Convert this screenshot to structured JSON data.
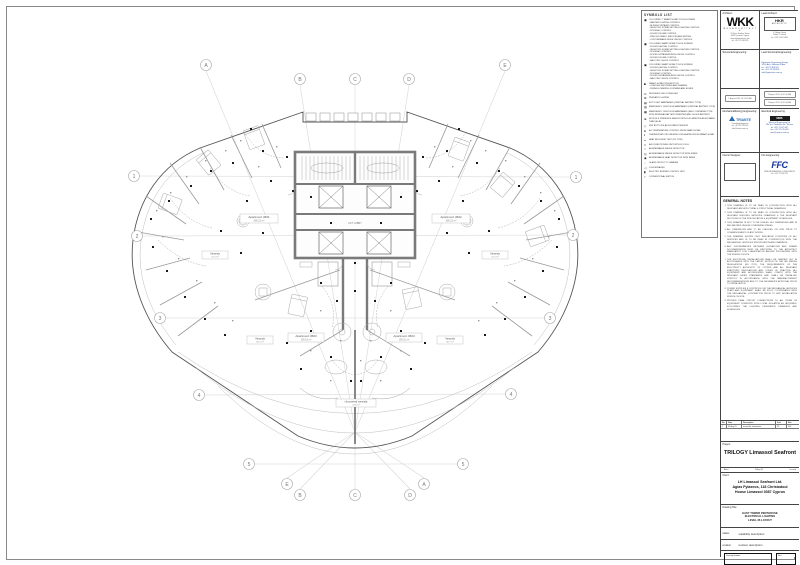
{
  "legend": {
    "title": "SYMBOLS LIST",
    "items": [
      {
        "glyph": "▣",
        "name": "touchscreen-7in-icon",
        "text": "COLOURED 7\" SMART HOME TOUCH SCREEN\n- MASTER LIGHTING CONTROL\n- BLINDS/CURTAINS CONTROL\n- SELECTED SCENE SETTING LIGHTING CONTROL\n- ROOM A/C CONTROL\n- ROOM VOLUME CONTROL\n- RING DOORBELL (INDOOR) AND MUTING\n- CUSTOMISABLE MODE ON/OFF CONTROL"
      },
      {
        "glyph": "▣",
        "name": "touchscreen-icon",
        "text": "COLOURED SMART HOME TOUCH SCREEN\n- ROOM LIGHTING CONTROL\n- SELECTED SCENE SETTING LIGHTING CONTROL\n- ROOM A/C CONTROL\n- ROOM CURTAINS/BLINDS ON/OFF CONTROL\n- ROOM VOLUME CONTROL\n- BALCONY LIGHTS CONTROL"
      },
      {
        "glyph": "▣",
        "name": "touchscreen-icon",
        "text": "COLOURED SMART HOME TOUCH SCREEN\n- ROOM LIGHTING CONTROL\n- SELECTED SCENE SETTING LIGHTING CONTROL\n- ROOM A/C CONTROL\n- ROOM CURTAINS/BLINDS ON/OFF CONTROL\n- BALCONY LIGHTS CONTROL"
      },
      {
        "glyph": "■",
        "name": "push-button-icon",
        "text": "SMART HOME PUSH BUTTON\n- LIGHTING SWITCHING AND DIMMING\n- RISING/LOWERING CURTAINS AND BLINDS"
      },
      {
        "glyph": "⊙",
        "name": "downlight-icon",
        "text": "RECESSED LED DOWNLIGHT"
      },
      {
        "glyph": "⊗",
        "name": "pendant-icon",
        "text": "PENDANT LIGHTING"
      },
      {
        "glyph": "▤",
        "name": "exit-light-icon",
        "text": "EXIT LIGHT MAINTAINED (CENTRAL BATTERY TYPE)"
      },
      {
        "glyph": "▥",
        "name": "emergency-light-icon",
        "text": "EMERGENCY LIGHT NON MAINTAINED (CENTRAL BATTERY TYPE)"
      },
      {
        "glyph": "▦",
        "name": "emergency-light-self-icon",
        "text": "EMERGENCY LIGHT NON MAINTAINED (SELF CONTAINED TYPE WITH INTERNAL BATTERY INVERTER AND 3 HOUR BATTERY)"
      },
      {
        "glyph": "⊕",
        "name": "motion-sensor-icon",
        "text": "MOTION & PRESENCE SENSOR WITH 0-30 MINUTES ADJUSTABLE TIME DELAY"
      },
      {
        "glyph": "◇",
        "name": "knx-button-icon",
        "text": "KNX BUTTON & ADJUSTMENT SENSOR"
      },
      {
        "glyph": "●",
        "name": "ac-control-icon",
        "text": "A/C TEMPERATURE CONTROL FROM SMART HOME"
      },
      {
        "glyph": "◐",
        "name": "thermostat-icon",
        "text": "THERMOSTAT FOR UNDERFLOOR HEATING FROM SMART HOME"
      },
      {
        "glyph": "◒",
        "name": "heat-recovery-icon",
        "text": "HEAT RECOVERY UNIT (VS TYPE)"
      },
      {
        "glyph": "□",
        "name": "fcu-icon",
        "text": "AIR CONDITIONING UNIT WITH FCU FILL"
      },
      {
        "glyph": "○",
        "name": "smoke-detector-icon",
        "text": "ADDRESSABLE SMOKE DETECTOR"
      },
      {
        "glyph": "◎",
        "name": "smoke-detector-siren-icon",
        "text": "ADDRESSABLE SMOKE DETECTOR WITH SIREN"
      },
      {
        "glyph": "◉",
        "name": "heat-detector-siren-icon",
        "text": "ADDRESSABLE HEAT DETECTOR WITH SIREN"
      },
      {
        "glyph": "◌",
        "name": "glass-circuit-icon",
        "text": "GLASS CIRCUIT TO CAMERA"
      },
      {
        "glyph": "◁",
        "name": "loudspeaker-icon",
        "text": "LOUDSPEAKER"
      },
      {
        "glyph": "▮",
        "name": "burner-unit-icon",
        "text": "ELECTRIC BURNER CONTROL UNIT"
      },
      {
        "glyph": "⌐",
        "name": "conventional-switch-icon",
        "text": "CONVENTIONAL SWITCH"
      }
    ]
  },
  "titleblock": {
    "architect": {
      "label": "Architect:",
      "logo": "WKK",
      "sub": "W K K   A R C H I T E C T S",
      "addr": "14 Zinas Kanther Street\n3035 Limassol, Cyprus\nwww.wkkarchitects.com\ntel: +357 25 368 926"
    },
    "lead_architect": {
      "label": "Lead Architect:",
      "logo": "HKR",
      "logosub": "ARCHITECTS",
      "addr": "5 College Green\nDublin 2, Ireland\ntel: +353 1 453 5666"
    },
    "structural": {
      "label": "Structural Engineering:"
    },
    "lead_structural": {
      "label": "Lead Structural Engineering:",
      "addr": "Hyperstatic Engineering Design\n14-16 Arch. Makariou III Ave.\ntel: +357 25 818 855\nfax: +357 25 818 856\ninfo@hyperstatic.com.cy"
    },
    "stamp_left": "1 August 2021 10:37:45 AM",
    "stamp_right_1": "1 August 2021 10:37:45 AM",
    "stamp_right_2": "1 August 2021 10:37:46 AM",
    "mech": {
      "label": "Mechanical/Energy Engineering:",
      "logo": "TRIANTE",
      "addr": "Consulting Engineers\ntel: +357 22 518 000\ninfo@triante.com.cy"
    },
    "elec": {
      "label": "Electrical Engineering:",
      "logo": "MMS",
      "addr": "Electrical Engineering Ltd\n26a Vas. Freiderikis Str., Nicosia\ntel: +357 22 675 447\nfax: +357 22 675 448\nmms@cytanet.com.cy"
    },
    "interior": {
      "label": "Interior Designer:"
    },
    "fire": {
      "label": "Fire Engineering:",
      "logo": "FFC",
      "addr": "FIRE ENGINEERING CONSULTANTS\ntel: +357 22 358 222"
    },
    "notes": {
      "title": "GENERAL NOTES",
      "items": [
        "THIS DRAWING IS TO BE READ IN CONJUNCTION WITH ALL RELEVANT ARCHITECTURAL & STRUCTURAL DRAWINGS.",
        "THIS DRAWING IS TO BE READ IN CONJUNCTION WITH ALL RELEVANT BUILDING SERVICES DRAWINGS & THE RELEVANT SECTIONS OF THE SPECIFICATION & EQUIPMENT SCHEDULES.",
        "THIS DRAWING IS NOT TO BE SCALED. ALL DIMENSIONS ARE IN MILLIMETRES UNLESS OTHERWISE STATED.",
        "ALL DIMENSIONS ARE TO BE CHECKED ON SITE PRIOR TO COMMENCEMENT OF ANY WORKS.",
        "THE DRAWING SHOWS ONLY INDICATIVE POSITIONS OF ALL SERVICES AND IS TO BE READ IN CONJUNCTION WITH THE MECHANICAL, SERVICES SPECIFICATION AND DRAWINGS.",
        "ANY DISCREPANCIES BETWEEN ELEVATIONS AND DRAWN DOCUMENTATION MUST BE REPORTED TO THE ARCHITECT IMMEDIATELY FOR CLARIFICATION BEFORE PROCEEDING WITH THE WORKS ON SITE.",
        "THE ELECTRICAL INSTALLATIONS SHALL BE CARRIED OUT IN ACCORDANCE WITH THE LATEST EDITION OF THE IEE WIRING REGULATIONS (BS 7671), THE REQUIREMENTS OF THE ELECTRICITY AUTHORITY OF CYPRUS AND ALL RELEVANT STATUTORY REGULATIONS AND CODES OF PRACTICE. ALL EQUIPMENT AND ACCESSORIES SHALL COMPLY WITH THE RELEVANT BS/EN STANDARDS AND SHALL BE INSTALLED STRICTLY IN ACCORDANCE WITH THE MANUFACTURERS' RECOMMENDATIONS AND TO THE ENGINEER'S APPROVAL PRIOR TO INSTALLATION.",
        "POWER SUPPLIES & CONTROLS FOR THE MECHANICAL SERVICES PLANT AND EQUIPMENT SHALL BE FULLY COORDINATED WITH THE MECHANICAL CONTRACTOR PRIOR TO ANY INSTALLATION WORKS ON SITE.",
        "PROVIDE FINAL CIRCUIT CONNECTIONS TO ALL ITEMS OF EQUIPMENT COMPLETE WITH LOCAL ISOLATION AS REQUIRED, FOLLOWING THE LIGHTING DESIGNER'S DRAWINGS AND SCHEDULES."
      ]
    },
    "revtable": {
      "headers": [
        "No.",
        "Date",
        "Description",
        "Suit.",
        "Rev."
      ],
      "row": {
        "no": "1",
        "date": "01 Aug 21",
        "desc": "Issued for information",
        "suit": "S2",
        "rev": "P01"
      }
    },
    "project": {
      "label": "Project:",
      "name": "TRILOGY Limassol Seafront",
      "scale": "Auto",
      "date": "1 Aug 21",
      "issued": "Issued"
    },
    "client": {
      "label": "Client:",
      "line1": "LH Limassol Seafront Ltd.",
      "line2": "Agias Fylaxeos, 118 Christodoul",
      "line3": "House Limassol 3087 Cyprus"
    },
    "drawing": {
      "label": "Drawing Title:",
      "line1": "EAST TOWER PENTHOUSE",
      "line2": "ELECTRICAL LIGHTING",
      "line3": "LEVEL 36 LAYOUT"
    },
    "status": {
      "label": "status:",
      "value": "suitability description"
    },
    "revision": {
      "label": "revision:",
      "value": "revision description"
    },
    "number_box": {
      "label": "Drawing Number:"
    },
    "rev_box": {
      "label": "Rev:"
    }
  },
  "plan": {
    "bubbles": [
      "A",
      "B",
      "C",
      "D",
      "E",
      "1",
      "2",
      "3",
      "4",
      "5",
      "1",
      "2",
      "3",
      "4",
      "5",
      "E",
      "B",
      "C",
      "D",
      "A"
    ],
    "labels": {
      "apt1": "Apartment 3601",
      "apt1_area": "286.15 m²",
      "apt2": "Apartment 3602",
      "apt2_area": "286.15 m²",
      "apt3": "Apartment 3603",
      "apt3_area": "190.10 m²",
      "apt4": "Apartment 3604",
      "apt4_area": "190.10 m²",
      "veranda_ul": "Veranda",
      "veranda_ul_area": "41.5 m²",
      "veranda_ur": "Veranda",
      "veranda_ur_area": "41.5 m²",
      "veranda_ll": "Veranda",
      "veranda_ll_area": "40.7 m²",
      "veranda_lr": "Veranda",
      "veranda_lr_area": "40.7 m²",
      "uncovered": "Uncovered veranda",
      "uncovered_area": "4.50 m²",
      "lobby": "LIFT LOBBY"
    }
  }
}
